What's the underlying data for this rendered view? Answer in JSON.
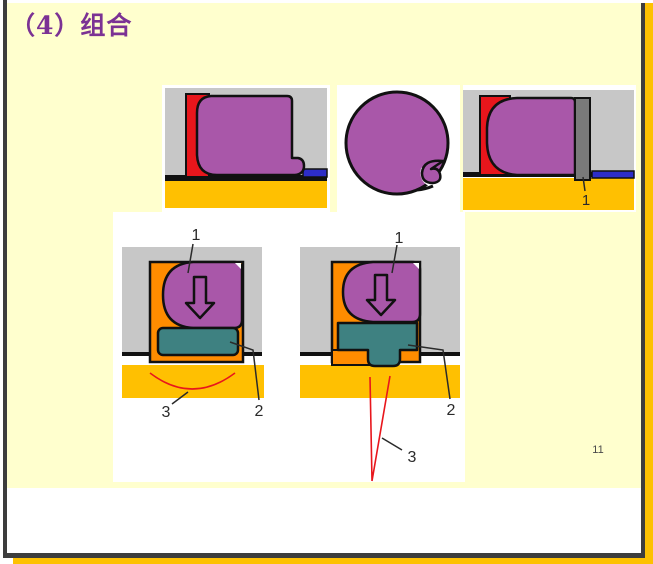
{
  "slide": {
    "title": "（4）组合",
    "page_number": "11"
  },
  "colors": {
    "purple": "#a957a9",
    "red": "#e8161c",
    "amber": "#ffc001",
    "blue": "#2d2dc8",
    "gray_block": "#c7c7c7",
    "gray_dark": "#7a7a7a",
    "orange": "#ff8c00",
    "teal": "#3e8181",
    "white": "#ffffff",
    "slide_bg": "#ffffce",
    "frame_dark": "#3d3d3d",
    "frame_orange": "#fdc101",
    "title_text": "#7b3294",
    "label_text": "#2a2a2a"
  },
  "diagrams": {
    "top_right": {
      "label_1": "1"
    },
    "bottom_left": {
      "label_1": "1",
      "label_2": "2",
      "label_3": "3"
    },
    "bottom_right": {
      "label_1": "1",
      "label_2": "2",
      "label_3": "3"
    }
  }
}
